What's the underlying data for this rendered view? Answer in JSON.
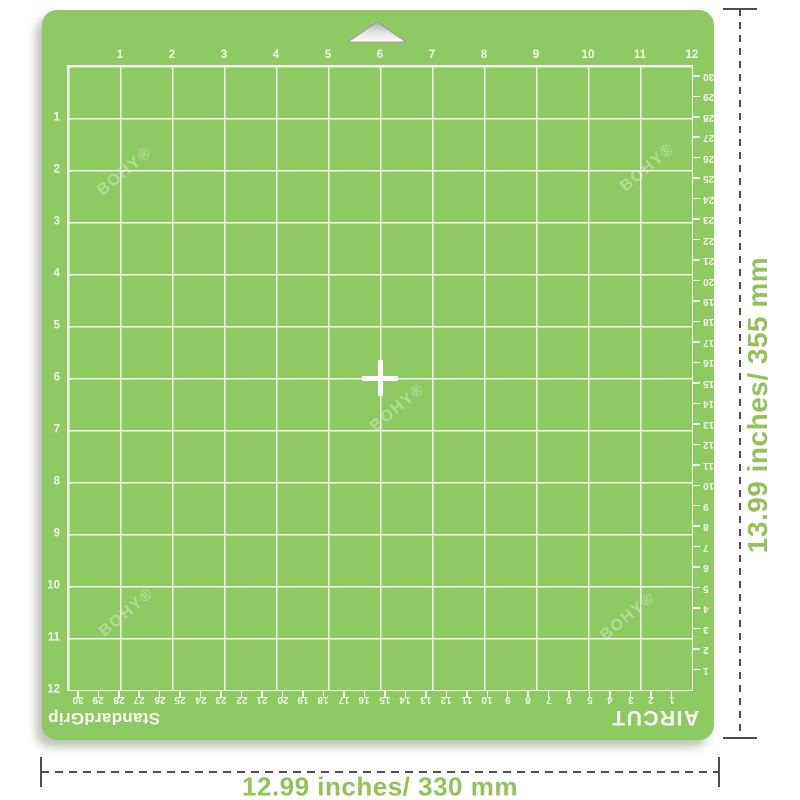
{
  "mat": {
    "brand": "AIRCUT",
    "grip_text": "StandardGrip",
    "watermark_text": "BOHY®",
    "color": "#8ec963",
    "grid_line_color": "#f2f8ea",
    "grid_squares": "12x12 inches"
  },
  "rulers": {
    "inch_top": [
      "1",
      "2",
      "3",
      "4",
      "5",
      "6",
      "7",
      "8",
      "9",
      "10",
      "11",
      "12"
    ],
    "inch_left": [
      "1",
      "2",
      "3",
      "4",
      "5",
      "6",
      "7",
      "8",
      "9",
      "10",
      "11",
      "12"
    ],
    "cm_right": [
      "1",
      "2",
      "3",
      "4",
      "5",
      "6",
      "7",
      "8",
      "9",
      "10",
      "11",
      "12",
      "13",
      "14",
      "15",
      "16",
      "17",
      "18",
      "19",
      "20",
      "21",
      "22",
      "23",
      "24",
      "25",
      "26",
      "27",
      "28",
      "29",
      "30"
    ],
    "cm_bottom": [
      "1",
      "2",
      "3",
      "4",
      "5",
      "6",
      "7",
      "8",
      "9",
      "10",
      "11",
      "12",
      "13",
      "14",
      "15",
      "16",
      "17",
      "18",
      "19",
      "20",
      "21",
      "22",
      "23",
      "24",
      "25",
      "26",
      "27",
      "28",
      "29",
      "30"
    ]
  },
  "annotations": {
    "height_label": "13.99 inches/ 355 mm",
    "width_label": "12.99 inches/ 330 mm",
    "text_color": "#94c25a",
    "line_color": "#4e4e4e"
  }
}
